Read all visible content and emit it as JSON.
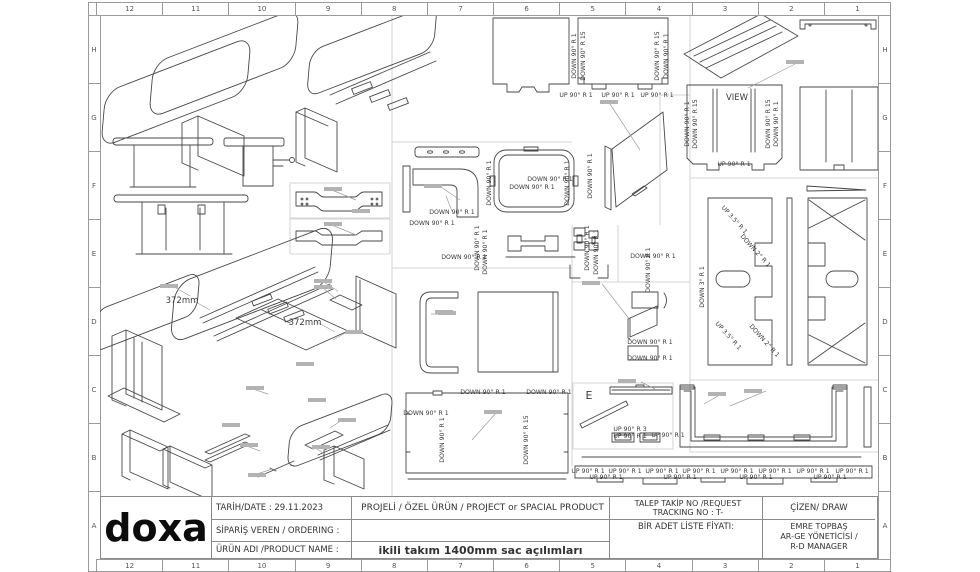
{
  "frame": {
    "columns": [
      "12",
      "11",
      "10",
      "9",
      "8",
      "7",
      "6",
      "5",
      "4",
      "3",
      "2",
      "1"
    ],
    "rows": [
      "H",
      "G",
      "F",
      "E",
      "D",
      "C",
      "B",
      "A"
    ]
  },
  "title_block": {
    "logo": "doxa",
    "date_label": "TARİH/DATE : 29.11.2023",
    "ordering_label": "SİPARİŞ VEREN / ORDERING :",
    "product_name_label": "ÜRÜN ADI /PRODUCT NAME :",
    "project_type": "PROJELİ / ÖZEL ÜRÜN  / PROJECT or SPACIAL PRODUCT",
    "product_name": "ikili takım 1400mm sac açılımları",
    "request_tracking_line1": "TALEP TAKİP NO /REQUEST",
    "request_tracking_line2": "TRACKING NO : T-",
    "unit_price_label": "BİR ADET LİSTE FİYATI:",
    "drawer_label": "ÇİZEN/ DRAW",
    "drawer_name": "EMRE TOPBAŞ",
    "drawer_title1": "AR-GE YÖNETİCİSİ /",
    "drawer_title2": "R-D MANAGER",
    "line_color": "#8a8a8a"
  },
  "drawing": {
    "ink_color": "#474747",
    "grid_color": "#c9c9c9",
    "labels": [
      {
        "t": "372mm",
        "x": 182,
        "y": 303,
        "r": 0,
        "s": 8.5
      },
      {
        "t": "372mm",
        "x": 305,
        "y": 325,
        "r": 0,
        "s": 8.5
      },
      {
        "t": "DOWN 90° R 1",
        "x": 576,
        "y": 56,
        "r": -90
      },
      {
        "t": "DOWN 90° R 15",
        "x": 585,
        "y": 56,
        "r": -90
      },
      {
        "t": "DOWN 90° R 15",
        "x": 659,
        "y": 56,
        "r": -90
      },
      {
        "t": "DOWN 90° R 1",
        "x": 668,
        "y": 56,
        "r": -90
      },
      {
        "t": "UP 90° R 1",
        "x": 576,
        "y": 97,
        "r": 0
      },
      {
        "t": "UP 90° R 1",
        "x": 618,
        "y": 97,
        "r": 0
      },
      {
        "t": "UP 90° R 1",
        "x": 657,
        "y": 97,
        "r": 0
      },
      {
        "t": "DOWN 90° R 1",
        "x": 452,
        "y": 214,
        "r": 0
      },
      {
        "t": "DOWN 90° R 1",
        "x": 432,
        "y": 225,
        "r": 0
      },
      {
        "t": "DOWN 90° R 1",
        "x": 479,
        "y": 248,
        "r": -90
      },
      {
        "t": "DOWN 90° R 1",
        "x": 487,
        "y": 252,
        "r": -90
      },
      {
        "t": "DOWN 90° R 1",
        "x": 464,
        "y": 259,
        "r": 0
      },
      {
        "t": "DOWN 90° R 1",
        "x": 491,
        "y": 183,
        "r": -90
      },
      {
        "t": "DOWN 90° R 1",
        "x": 569,
        "y": 183,
        "r": -90
      },
      {
        "t": "DOWN 90° R 1",
        "x": 532,
        "y": 189,
        "r": 0
      },
      {
        "t": "DOWN 90° R 1",
        "x": 550,
        "y": 181,
        "r": 0
      },
      {
        "t": "DOWN 90° R 1",
        "x": 592,
        "y": 176,
        "r": -90
      },
      {
        "t": "DOWN 90° R 1",
        "x": 589,
        "y": 248,
        "r": -90
      },
      {
        "t": "DOWN 90° R 1",
        "x": 598,
        "y": 252,
        "r": -90
      },
      {
        "t": "DOWN 90° R 1",
        "x": 653,
        "y": 258,
        "r": 0
      },
      {
        "t": "DOWN 90° R 1",
        "x": 650,
        "y": 270,
        "r": -90
      },
      {
        "t": "DOWN 90° R 1",
        "x": 650,
        "y": 344,
        "r": 0
      },
      {
        "t": "DOWN 90° R 1",
        "x": 650,
        "y": 360,
        "r": 0
      },
      {
        "t": "VIEW",
        "x": 737,
        "y": 100,
        "r": 0,
        "s": 8.5
      },
      {
        "t": "DOWN 90° R 1",
        "x": 689,
        "y": 124,
        "r": -90
      },
      {
        "t": "DOWN 90° R 15",
        "x": 697,
        "y": 124,
        "r": -90
      },
      {
        "t": "DOWN 90° R 15",
        "x": 770,
        "y": 124,
        "r": -90
      },
      {
        "t": "DOWN 90° R 1",
        "x": 778,
        "y": 124,
        "r": -90
      },
      {
        "t": "UP 90° R 1",
        "x": 734,
        "y": 166,
        "r": 0
      },
      {
        "t": "UP 3.5° R 1",
        "x": 733,
        "y": 221,
        "r": 48
      },
      {
        "t": "DOWN 2° R 1",
        "x": 754,
        "y": 252,
        "r": 48
      },
      {
        "t": "DOWN 3° R 1",
        "x": 704,
        "y": 287,
        "r": -90
      },
      {
        "t": "UP 3.5° R 1",
        "x": 727,
        "y": 337,
        "r": 48
      },
      {
        "t": "DOWN 2° R 1",
        "x": 763,
        "y": 342,
        "r": 48
      },
      {
        "t": "DOWN 90° R 1",
        "x": 483,
        "y": 394,
        "r": 0
      },
      {
        "t": "DOWN 90° R 1",
        "x": 549,
        "y": 394,
        "r": 0
      },
      {
        "t": "DOWN 90° R 1",
        "x": 426,
        "y": 415,
        "r": 0
      },
      {
        "t": "DOWN 90° R 1",
        "x": 444,
        "y": 440,
        "r": -90
      },
      {
        "t": "DOWN 90° R 15",
        "x": 528,
        "y": 440,
        "r": -90
      },
      {
        "t": "E",
        "x": 589,
        "y": 399,
        "r": 0,
        "s": 11
      },
      {
        "t": "UP 90° R 3",
        "x": 630,
        "y": 431,
        "r": 0
      },
      {
        "t": "UP 90° R 1",
        "x": 630,
        "y": 438,
        "r": 0
      },
      {
        "t": "UP 90° R 1",
        "x": 668,
        "y": 437,
        "r": 0
      },
      {
        "t": "UP 90° R 1",
        "x": 588,
        "y": 473,
        "r": 0
      },
      {
        "t": "UP 90° R 1",
        "x": 625,
        "y": 473,
        "r": 0
      },
      {
        "t": "UP 90° R 1",
        "x": 662,
        "y": 473,
        "r": 0
      },
      {
        "t": "UP 90° R 1",
        "x": 699,
        "y": 473,
        "r": 0
      },
      {
        "t": "UP 90° R 1",
        "x": 737,
        "y": 473,
        "r": 0
      },
      {
        "t": "UP 90° R 1",
        "x": 775,
        "y": 473,
        "r": 0
      },
      {
        "t": "UP 90° R 1",
        "x": 813,
        "y": 473,
        "r": 0
      },
      {
        "t": "UP 90° R 1",
        "x": 852,
        "y": 473,
        "r": 0
      },
      {
        "t": "UP 90° R 1",
        "x": 606,
        "y": 479,
        "r": 0
      },
      {
        "t": "UP 90° R 1",
        "x": 680,
        "y": 479,
        "r": 0
      },
      {
        "t": "UP 90° R 1",
        "x": 756,
        "y": 479,
        "r": 0
      },
      {
        "t": "UP 90° R 1",
        "x": 830,
        "y": 479,
        "r": 0
      }
    ],
    "callouts": [
      [
        160,
        284
      ],
      [
        314,
        279
      ],
      [
        314,
        285
      ],
      [
        345,
        330
      ],
      [
        296,
        362
      ],
      [
        246,
        386
      ],
      [
        308,
        398
      ],
      [
        338,
        418
      ],
      [
        222,
        423
      ],
      [
        240,
        443
      ],
      [
        312,
        445
      ],
      [
        248,
        473
      ],
      [
        424,
        184
      ],
      [
        438,
        311
      ],
      [
        484,
        410
      ],
      [
        600,
        100
      ],
      [
        582,
        281
      ],
      [
        618,
        379
      ],
      [
        708,
        392
      ],
      [
        744,
        389
      ],
      [
        786,
        60
      ],
      [
        324,
        187
      ],
      [
        324,
        222
      ],
      [
        352,
        209
      ],
      [
        435,
        310
      ]
    ]
  }
}
